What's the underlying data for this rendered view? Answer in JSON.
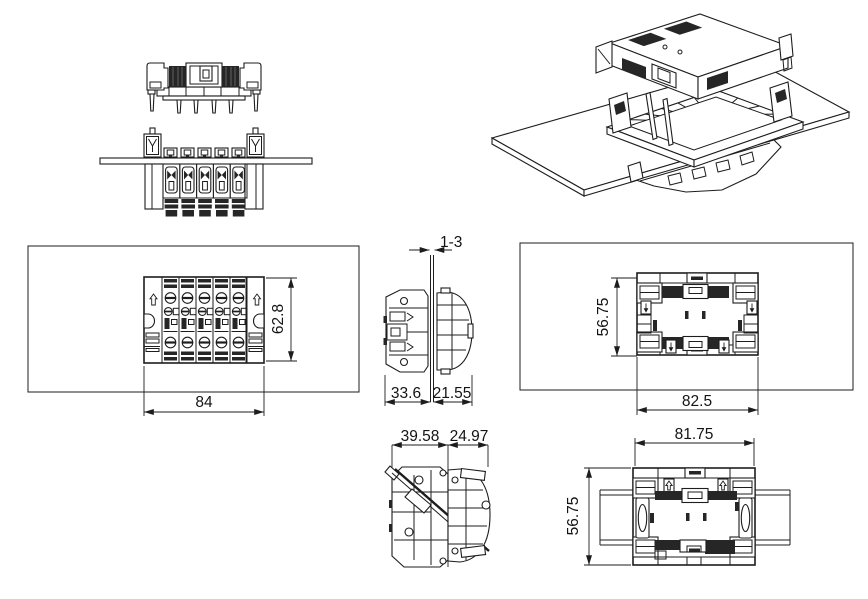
{
  "document": {
    "background": "#ffffff",
    "line_color": "#1d1d1d",
    "dark_fill": "#262626",
    "text_color": "#141414"
  },
  "dimensions": {
    "panel_thickness": "1-3",
    "cutout_height": "62.8",
    "cutout_width": "84",
    "front_depth": "33.6",
    "rear_depth": "21.55",
    "frame_height": "56.75",
    "frame_width": "82.5",
    "front_depth_latched": "39.58",
    "rear_depth_latched": "24.97",
    "rail_width": "81.75",
    "rail_height": "56.75"
  }
}
